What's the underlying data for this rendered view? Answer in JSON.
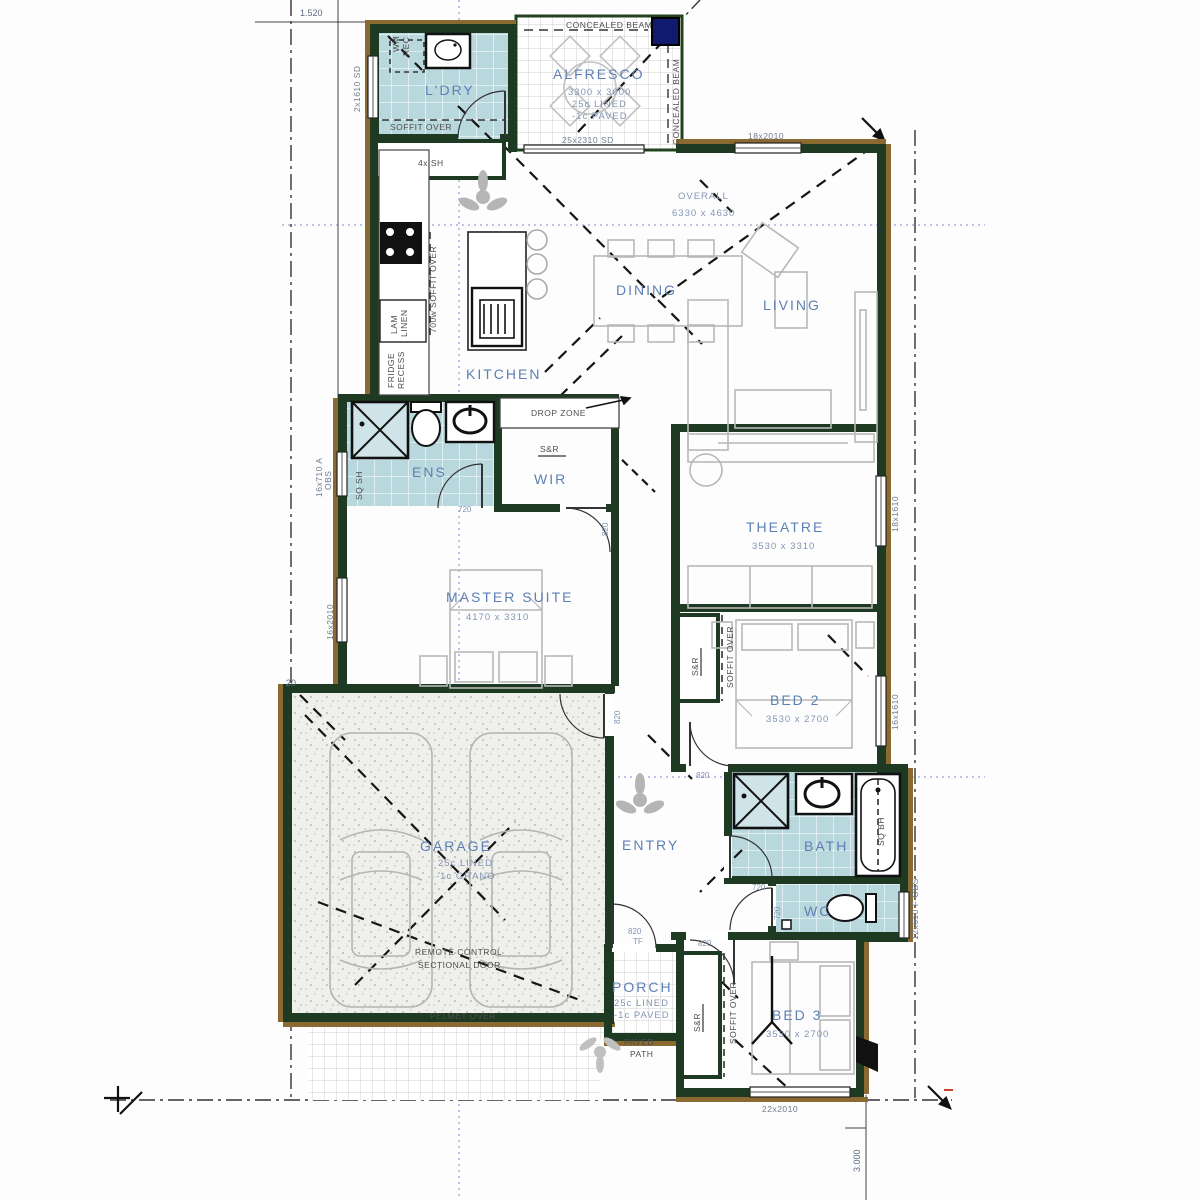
{
  "labels": {
    "ldry": "L'DRY",
    "alfresco": "ALFRESCO",
    "alfresco_dim": "3300 x 3000",
    "lined": "25c LINED",
    "paved_c": "-1c PAVED",
    "kitchen": "KITCHEN",
    "dining": "DINING",
    "living": "LIVING",
    "overall": "OVERALL",
    "overall_dim": "6330 x 4630",
    "ens": "ENS",
    "wir": "WIR",
    "drop_zone": "DROP ZONE",
    "s_r": "S&R",
    "master": "MASTER SUITE",
    "master_dim": "4170 x 3310",
    "theatre": "THEATRE",
    "theatre_dim": "3530 x 3310",
    "bed2": "BED 2",
    "bed2_dim": "3530 x 2700",
    "garage": "GARAGE",
    "garage_grano": "-1c GRANO",
    "entry": "ENTRY",
    "bath": "BATH",
    "wc": "WC",
    "porch": "PORCH",
    "bed3": "BED 3",
    "bed3_dim": "3530 x 2700",
    "concealed_beam": "CONCEALED BEAM",
    "soffit_over": "SOFFIT OVER",
    "soffit_700": "700w SOFFIT OVER",
    "wm": "WM",
    "rec": "REC",
    "sh4": "4x SH",
    "lam": "LAM",
    "linen": "LINEN",
    "fridge": "FRIDGE",
    "recess": "RECESS",
    "sq_sh": "SQ SH",
    "sq_bh": "SQ BH",
    "remote_1": "REMOTE CONTROL",
    "remote_2": "SECTIONAL DOOR",
    "pelmet": "PELMET OVER",
    "paved": "PAVED",
    "path": "PATH"
  },
  "windows": {
    "ldry": "2x1610 SD",
    "alfresco": "25x2310 SD",
    "living": "18x2010",
    "ens_a": "16x710 A",
    "ens_b": "OBS",
    "master": "16x2010",
    "theatre": "18x1610",
    "bed2": "16x1610",
    "wc": "12x610 F OBS",
    "bed3": "22x2010"
  },
  "doors": {
    "d720": "720",
    "d820": "820",
    "tf": "TF"
  },
  "dims": {
    "top": "1.520",
    "bottom": "3.000",
    "lot": "20"
  },
  "colors": {
    "wall": "#1e3a22",
    "brick": "#8a6a30",
    "tile": "#b9d8dd",
    "post": "#101a6e",
    "room_text": "#5d80b4"
  }
}
